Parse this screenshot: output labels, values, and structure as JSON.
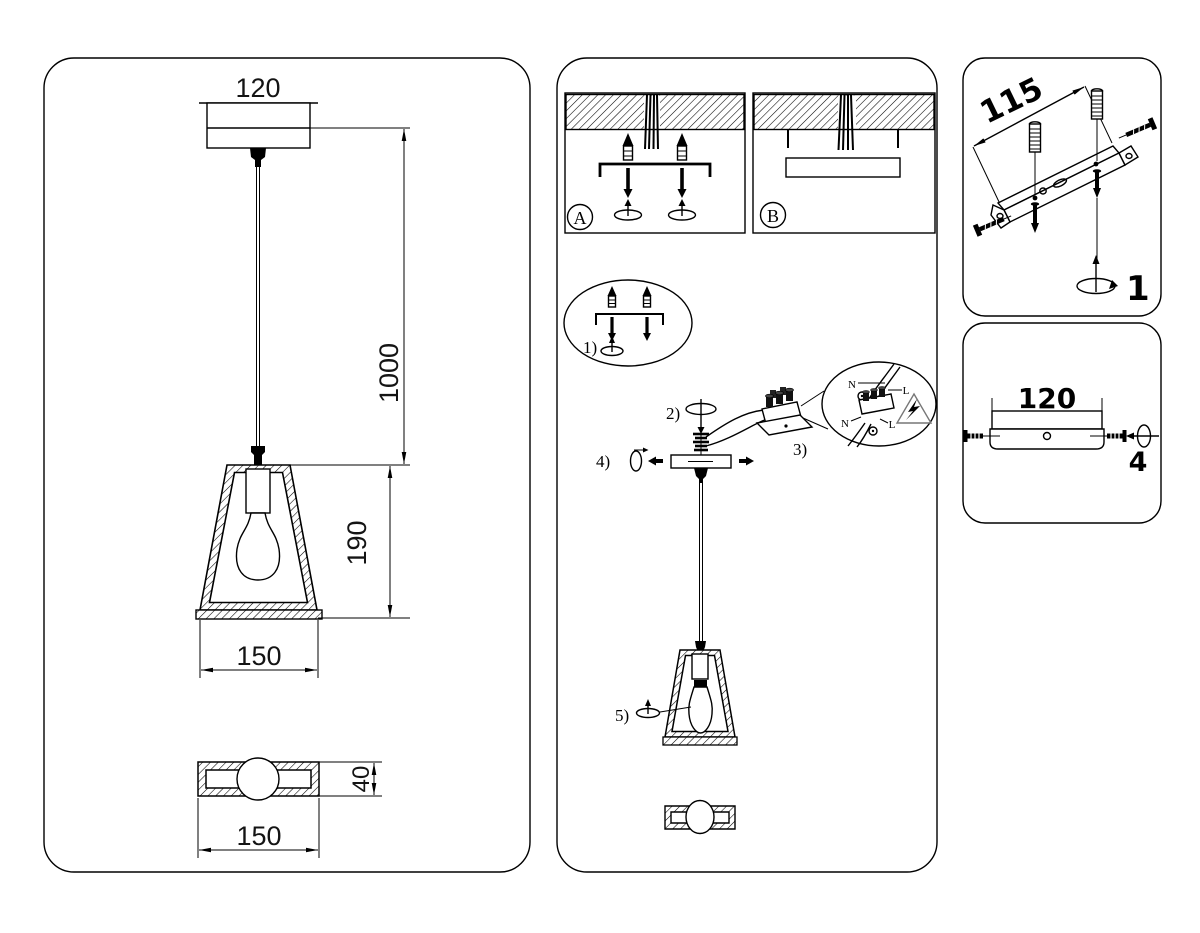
{
  "left": {
    "canopy_width": "120",
    "cord_length": "1000",
    "shade_height": "190",
    "shade_width": "150",
    "plate_width": "150",
    "plate_depth": "40"
  },
  "middle": {
    "option_a": "A",
    "option_b": "B",
    "step1": "1)",
    "step2": "2)",
    "step3": "3)",
    "step4": "4)",
    "step5": "5)",
    "wire_n_top": "N",
    "wire_l_top": "L",
    "wire_n_bottom": "N",
    "wire_l_bottom": "L"
  },
  "right_top": {
    "bracket_length": "115",
    "step": "1"
  },
  "right_bottom": {
    "plate_width": "120",
    "step": "4"
  }
}
